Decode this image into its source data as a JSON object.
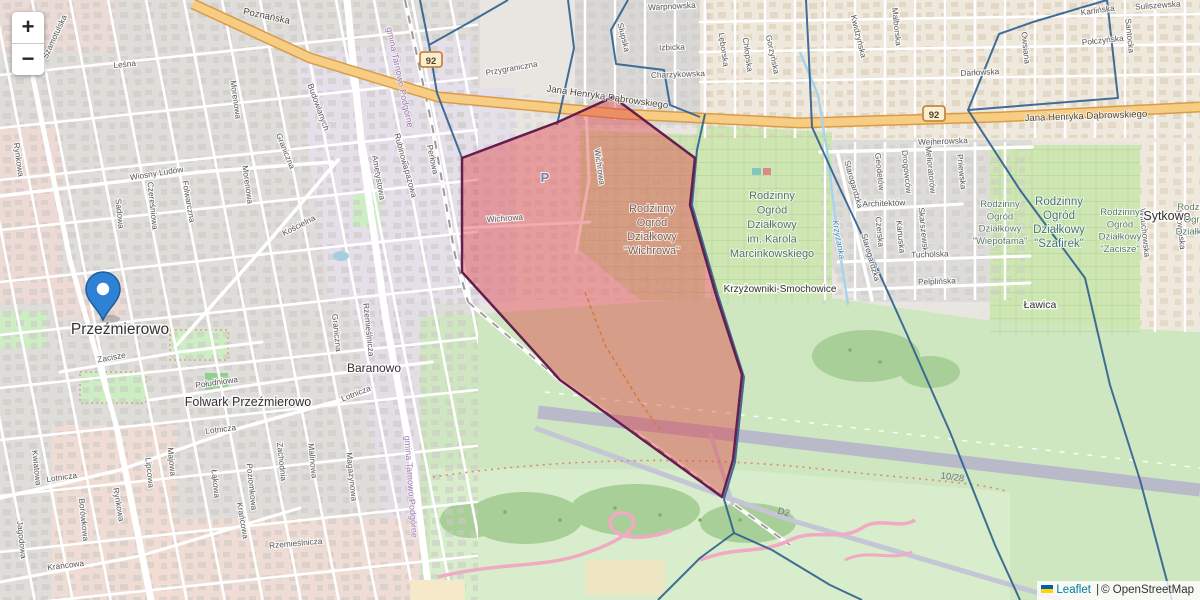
{
  "ui": {
    "zoom_in_label": "+",
    "zoom_out_label": "−",
    "attribution": {
      "leaflet": "Leaflet",
      "separator": "|",
      "copyright": "© OpenStreetMap"
    }
  },
  "colors": {
    "highlight_fill": "rgba(225,58,62,0.42)",
    "highlight_stroke": "#641f4e",
    "boundary_stroke": "#2d5f8e",
    "main_road": "#f7cd84",
    "marker_blue": "#2e82d6",
    "leaflet_link": "#0078a8",
    "flag_top": "#005bbb",
    "flag_bottom": "#ffd500"
  },
  "marker": {
    "x": 103,
    "y": 320
  },
  "labels": {
    "places": [
      {
        "t": "Przeźmierowo",
        "x": 120,
        "y": 334,
        "s": 15.5
      },
      {
        "t": "Folwark Przeźmierowo",
        "x": 248,
        "y": 406,
        "s": 12.5
      },
      {
        "t": "Baranowo",
        "x": 374,
        "y": 372,
        "s": 12
      },
      {
        "t": "Krzyżowniki-Smochowice",
        "x": 780,
        "y": 292,
        "s": 10
      },
      {
        "t": "Sytkowo",
        "x": 1167,
        "y": 220,
        "s": 12.5
      },
      {
        "t": "Ławica",
        "x": 1040,
        "y": 308,
        "s": 10.5
      }
    ],
    "roads": [
      {
        "t": "Poznańska",
        "x": 266,
        "y": 19,
        "r": 12
      },
      {
        "t": "Jana Henryka Dąbrowskiego",
        "x": 607,
        "y": 100,
        "r": 8
      },
      {
        "t": "Jana Henryka Dąbrowskiego",
        "x": 1086,
        "y": 119,
        "r": -2
      }
    ],
    "shields": {
      "text": "92",
      "positions": [
        {
          "x": 431,
          "y": 62
        },
        {
          "x": 934,
          "y": 116
        }
      ]
    },
    "airport": [
      {
        "t": "10/28",
        "x": 952,
        "y": 480,
        "r": 8
      },
      {
        "t": "D2",
        "x": 783,
        "y": 515,
        "r": 14
      }
    ],
    "water": [
      {
        "t": "Krzyżanka",
        "x": 836,
        "y": 240,
        "r": 80
      }
    ],
    "boundaries": [
      {
        "t": "gmina Tarnowo Podgórne",
        "x": 397,
        "y": 78,
        "r": 78
      },
      {
        "t": "gmina Tarnowo Podgórne",
        "x": 408,
        "y": 487,
        "r": 86
      }
    ],
    "parking": {
      "t": "P",
      "x": 545,
      "y": 182
    },
    "areas": [
      {
        "x": 652,
        "y": 212,
        "lh": 14,
        "s": 11,
        "color": "#7b6152",
        "lines": [
          "Rodzinny",
          "Ogród",
          "Działkowy",
          "\"Wichrowa\""
        ]
      },
      {
        "x": 772,
        "y": 199,
        "lh": 14.5,
        "s": 11,
        "color": "#52735f",
        "lines": [
          "Rodzinny",
          "Ogród",
          "Działkowy",
          "im. Karola",
          "Marcinkowskiego"
        ]
      },
      {
        "x": 1000,
        "y": 207,
        "lh": 12.3,
        "s": 9.5,
        "color": "#5b7a64",
        "lines": [
          "Rodzinny",
          "Ogród",
          "Działkowy",
          "\"Wiepofama\""
        ]
      },
      {
        "x": 1059,
        "y": 205,
        "lh": 14,
        "s": 11.5,
        "color": "#46756b",
        "lines": [
          "Rodzinny",
          "Ogród",
          "Działkowy",
          "\"Szafirek\""
        ]
      },
      {
        "x": 1120,
        "y": 215,
        "lh": 12.3,
        "s": 9.5,
        "color": "#5b7a64",
        "lines": [
          "Rodzinny",
          "Ogród",
          "Działkowy",
          "\"Zacisze\""
        ]
      },
      {
        "x": 1197,
        "y": 210,
        "lh": 12.3,
        "s": 9.5,
        "color": "#5b7a64",
        "lines": [
          "Rodzinny",
          "Ogród",
          "Działkowy"
        ]
      }
    ],
    "streets": [
      {
        "t": "Szamotulska",
        "x": 57,
        "y": 38,
        "r": -65
      },
      {
        "t": "Leśna",
        "x": 125,
        "y": 67,
        "r": -6
      },
      {
        "t": "Wiosny Ludów",
        "x": 157,
        "y": 176,
        "r": -9
      },
      {
        "t": "Rynkowa",
        "x": 16,
        "y": 160,
        "r": 82
      },
      {
        "t": "Rynkowa",
        "x": 116,
        "y": 505,
        "r": 80
      },
      {
        "t": "Sadowa",
        "x": 117,
        "y": 214,
        "r": 84
      },
      {
        "t": "Czereśniowa",
        "x": 150,
        "y": 206,
        "r": 84
      },
      {
        "t": "Folwarczna",
        "x": 186,
        "y": 202,
        "r": 80
      },
      {
        "t": "Morenowa",
        "x": 233,
        "y": 100,
        "r": 82
      },
      {
        "t": "Morenowa",
        "x": 245,
        "y": 185,
        "r": 82
      },
      {
        "t": "Graniczna",
        "x": 283,
        "y": 152,
        "r": 68
      },
      {
        "t": "Graniczna",
        "x": 334,
        "y": 333,
        "r": 84
      },
      {
        "t": "Kościelna",
        "x": 300,
        "y": 228,
        "r": -27
      },
      {
        "t": "Zacisze",
        "x": 112,
        "y": 360,
        "r": -10
      },
      {
        "t": "Południowa",
        "x": 217,
        "y": 385,
        "r": -8
      },
      {
        "t": "Lotnicza",
        "x": 221,
        "y": 432,
        "r": -7
      },
      {
        "t": "Lotnicza",
        "x": 357,
        "y": 396,
        "r": -22
      },
      {
        "t": "Lotnicza",
        "x": 62,
        "y": 480,
        "r": -8
      },
      {
        "t": "Krańcowa",
        "x": 66,
        "y": 568,
        "r": -7
      },
      {
        "t": "Krańcowa",
        "x": 240,
        "y": 521,
        "r": 80
      },
      {
        "t": "Jagodowa",
        "x": 19,
        "y": 540,
        "r": 84
      },
      {
        "t": "Kwiatowa",
        "x": 34,
        "y": 468,
        "r": 84
      },
      {
        "t": "Borówkowa",
        "x": 81,
        "y": 520,
        "r": 84
      },
      {
        "t": "Lipcowa",
        "x": 147,
        "y": 473,
        "r": 84
      },
      {
        "t": "Majowa",
        "x": 169,
        "y": 462,
        "r": 84
      },
      {
        "t": "Łąkowa",
        "x": 213,
        "y": 484,
        "r": 84
      },
      {
        "t": "Poziomkowa",
        "x": 249,
        "y": 487,
        "r": 84
      },
      {
        "t": "Zachodnia",
        "x": 279,
        "y": 462,
        "r": 84
      },
      {
        "t": "Malinowa",
        "x": 310,
        "y": 461,
        "r": 84
      },
      {
        "t": "Magazynowa",
        "x": 349,
        "y": 477,
        "r": 84
      },
      {
        "t": "Rzemieślnicza",
        "x": 366,
        "y": 330,
        "r": 84
      },
      {
        "t": "Rzemieślnicza",
        "x": 296,
        "y": 546,
        "r": -5
      },
      {
        "t": "Budowlanych",
        "x": 316,
        "y": 108,
        "r": 70
      },
      {
        "t": "Ametystowa",
        "x": 376,
        "y": 178,
        "r": 80
      },
      {
        "t": "Topazowa",
        "x": 407,
        "y": 180,
        "r": 75
      },
      {
        "t": "Rubinowa",
        "x": 399,
        "y": 152,
        "r": 75
      },
      {
        "t": "Perłowa",
        "x": 430,
        "y": 160,
        "r": 78
      },
      {
        "t": "Przygraniczna",
        "x": 512,
        "y": 71,
        "r": -10
      },
      {
        "t": "Wichrowa",
        "x": 597,
        "y": 167,
        "r": 82
      },
      {
        "t": "Wichrowa",
        "x": 505,
        "y": 221,
        "r": -4
      },
      {
        "t": "Warpnowska",
        "x": 672,
        "y": 9,
        "r": -3
      },
      {
        "t": "Słupska",
        "x": 621,
        "y": 38,
        "r": 76
      },
      {
        "t": "Izbicka",
        "x": 672,
        "y": 50,
        "r": -2
      },
      {
        "t": "Charzykowska",
        "x": 678,
        "y": 77,
        "r": -2
      },
      {
        "t": "Lęborska",
        "x": 721,
        "y": 50,
        "r": 82
      },
      {
        "t": "Chłopska",
        "x": 745,
        "y": 55,
        "r": 82
      },
      {
        "t": "Gorzyńska",
        "x": 770,
        "y": 55,
        "r": 78
      },
      {
        "t": "Kwidzyńska",
        "x": 856,
        "y": 37,
        "r": 76
      },
      {
        "t": "Malborska",
        "x": 894,
        "y": 27,
        "r": 84
      },
      {
        "t": "Karlińska",
        "x": 1098,
        "y": 13,
        "r": -8
      },
      {
        "t": "Suliszewska",
        "x": 1158,
        "y": 8,
        "r": -4
      },
      {
        "t": "Połczyńska",
        "x": 1103,
        "y": 43,
        "r": -6
      },
      {
        "t": "Santocka",
        "x": 1127,
        "y": 36,
        "r": 84
      },
      {
        "t": "Owsiana",
        "x": 1023,
        "y": 48,
        "r": 84
      },
      {
        "t": "Darłowska",
        "x": 980,
        "y": 75,
        "r": -3
      },
      {
        "t": "Wejherowska",
        "x": 943,
        "y": 144,
        "r": -2
      },
      {
        "t": "Starogardzka",
        "x": 851,
        "y": 185,
        "r": 74
      },
      {
        "t": "Starogardzka",
        "x": 868,
        "y": 258,
        "r": 74
      },
      {
        "t": "Geodetów",
        "x": 877,
        "y": 172,
        "r": 84
      },
      {
        "t": "Drogowców",
        "x": 904,
        "y": 172,
        "r": 84
      },
      {
        "t": "Melioratorów",
        "x": 928,
        "y": 170,
        "r": 84
      },
      {
        "t": "Pniewska",
        "x": 959,
        "y": 172,
        "r": 84
      },
      {
        "t": "Architektów",
        "x": 884,
        "y": 206,
        "r": -2
      },
      {
        "t": "Czerska",
        "x": 877,
        "y": 232,
        "r": 84
      },
      {
        "t": "Kartuska",
        "x": 898,
        "y": 237,
        "r": 84
      },
      {
        "t": "Skarszewska",
        "x": 921,
        "y": 232,
        "r": 84
      },
      {
        "t": "Tucholska",
        "x": 930,
        "y": 257,
        "r": -2
      },
      {
        "t": "Pelplińska",
        "x": 937,
        "y": 284,
        "r": -2
      },
      {
        "t": "Wituchowska",
        "x": 1142,
        "y": 233,
        "r": 84
      },
      {
        "t": "Mrowińska",
        "x": 1178,
        "y": 230,
        "r": 84
      }
    ]
  },
  "overlays": {
    "highlight": {
      "points": "462,158 558,122 613,97 695,158 690,205 716,295 742,375 733,460 722,497 560,380 462,272",
      "fill": "rgba(225,58,62,0.42)",
      "stroke": "#641f4e",
      "stroke_width": 2.5
    },
    "boundary_lines": [
      {
        "d": "M420,0 L429,45 L437,93 L462,158"
      },
      {
        "d": "M429,45 L470,22 L508,0"
      },
      {
        "d": "M568,0 L574,48 L557,125"
      },
      {
        "d": "M628,0 L611,30 L616,64 L664,70 L670,105 L700,117"
      },
      {
        "d": "M705,114 L697,150 L692,205 L718,295 L744,377 L735,462 L724,499 L734,533 L700,558 L658,600"
      },
      {
        "d": "M734,533 L772,550 L830,585 L862,600"
      },
      {
        "d": "M806,0 L809,60 L812,127 L836,180 L868,248 L905,330 L950,432 L995,545 L1020,600"
      },
      {
        "d": "M1107,0 L1033,22 L999,34 L968,110 L1118,98 Z"
      },
      {
        "d": "M968,110 L1020,190 L1085,278 L1110,385 L1140,480 L1172,600"
      }
    ]
  }
}
